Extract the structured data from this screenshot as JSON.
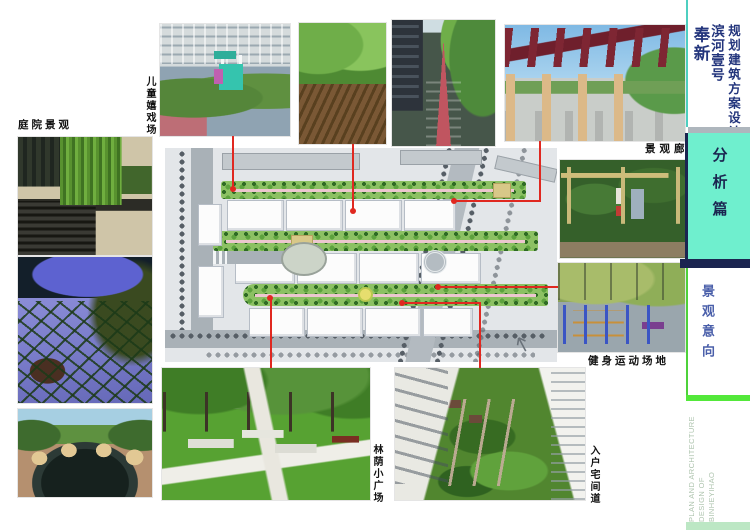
{
  "title_block": {
    "project_type": "规划建筑方案设计",
    "project_name": "滨河壹号",
    "location": "奉新",
    "section": "分析篇",
    "page_title": "景观意向",
    "footer_lines": [
      "PLAN AND ARCHITECTURE",
      "DESIGN OF",
      "BINHEYIHAO"
    ]
  },
  "photo_labels": {
    "courtyard": "庭院景观",
    "children_play": "儿童嬉戏场",
    "gallery": "景观廊",
    "fitness": "健身运动场地",
    "shaded_plaza": "林荫小广场",
    "entry_path": "入户宅间道"
  },
  "colors": {
    "accent_cyan": "#4ecfc0",
    "box_aqua": "#6fefce",
    "navy": "#1b2550",
    "text_navy": "#23357c",
    "blue_text": "#4a5faa",
    "accent_green": "#4ed23a",
    "footer_green": "#aec4ae",
    "red_line": "#e02820"
  }
}
